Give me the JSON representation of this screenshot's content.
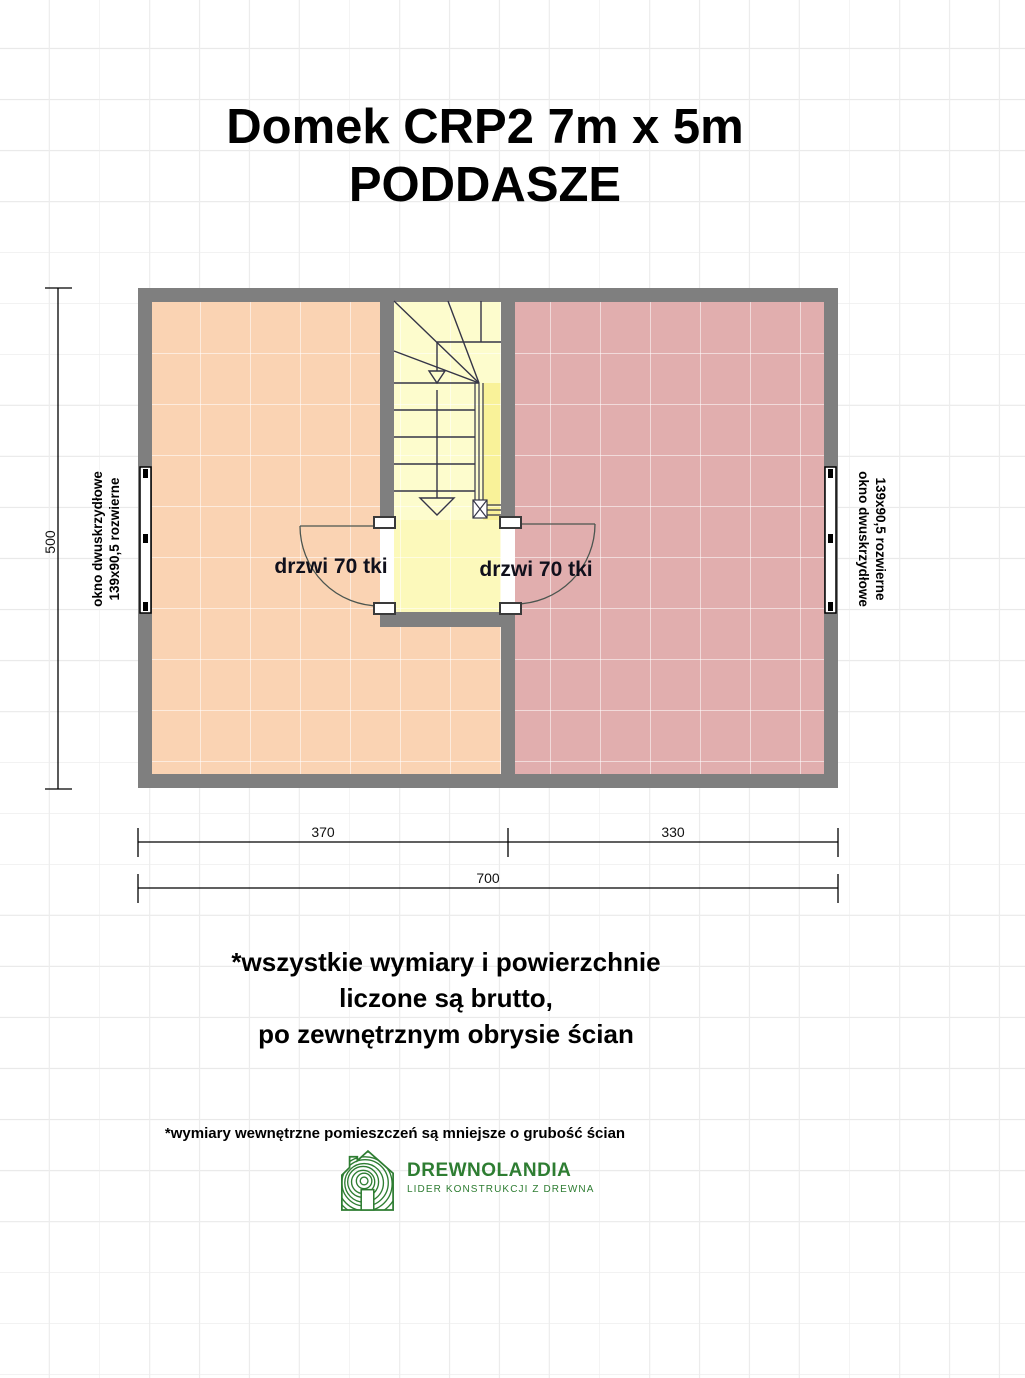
{
  "title": {
    "line1": "Domek CRP2 7m x 5m",
    "line2": "PODDASZE"
  },
  "plan": {
    "door_label_left": "drzwi 70 tki",
    "door_label_right": "drzwi 70 tki",
    "window_label_line1": "okno dwuskrzydłowe",
    "window_label_line2": "139x90,5 rozwierne",
    "dimensions": {
      "height_cm": "500",
      "width_left_cm": "370",
      "width_right_cm": "330",
      "width_total_cm": "700"
    },
    "colors": {
      "wall": "#7f7f7f",
      "room_left": "#fad3b3",
      "room_right": "#e1aeae",
      "staircase": "#fdfccd",
      "hallway": "#fcf9bb",
      "stair_strip": "#f9f299"
    }
  },
  "notes": {
    "main_line1": "*wszystkie wymiary i powierzchnie",
    "main_line2": "liczone są brutto,",
    "main_line3": "po zewnętrznym obrysie ścian",
    "secondary": "*wymiary wewnętrzne pomieszczeń są mniejsze o grubość ścian"
  },
  "logo": {
    "name": "DREWNOLANDIA",
    "tagline": "LIDER KONSTRUKCJI Z DREWNA",
    "icon": "wood-grain-house-icon",
    "color": "#2e7d32"
  }
}
